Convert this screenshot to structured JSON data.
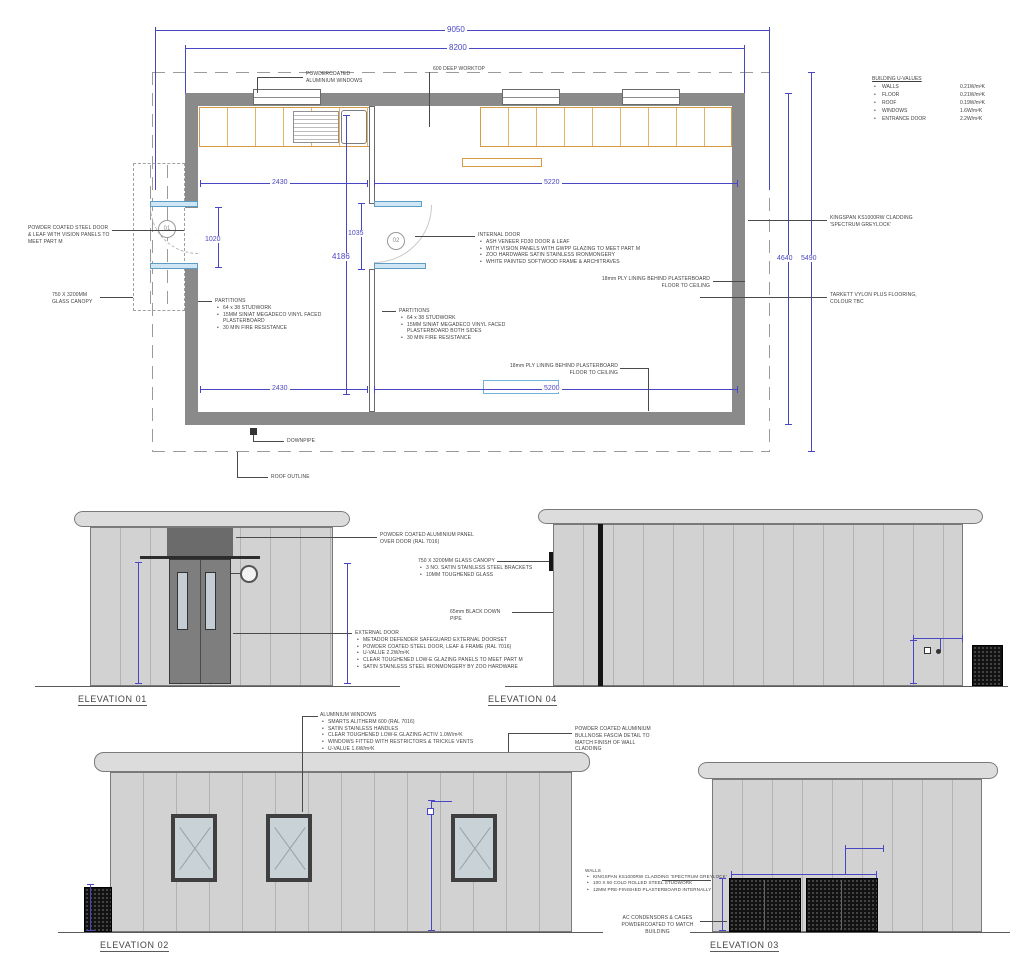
{
  "uvalues": {
    "title": "BUILDING U-VALUES",
    "rows": [
      {
        "name": "WALLS",
        "value": "0.21W/m²K"
      },
      {
        "name": "FLOOR",
        "value": "0.21W/m²K"
      },
      {
        "name": "ROOF",
        "value": "0.19W/m²K"
      },
      {
        "name": "WINDOWS",
        "value": "1.6W/m²K"
      },
      {
        "name": "ENTRANCE DOOR",
        "value": "2.2W/m²K"
      }
    ]
  },
  "plan": {
    "dims": {
      "overall_width": "9050",
      "inner_width": "8200",
      "room1_width_top": "2430",
      "room2_width_top": "5220",
      "door1_opening": "1020",
      "door2_opening": "1035",
      "internal_depth": "4186",
      "room1_width_bottom": "2430",
      "room2_width_bottom": "5200",
      "inner_depth_right": "4640",
      "overall_depth_right": "5490"
    },
    "door1_tag": "01",
    "door2_tag": "02",
    "windows_label": "POWDERCOATED ALUMINIUM WINDOWS",
    "worktop_label": "600 DEEP WORKTOP",
    "entrance_door_label": "POWDER COATED STEEL DOOR & LEAF WITH VISION PANELS TO MEET PART M",
    "canopy_label": "750 X 3200MM GLASS CANOPY",
    "cladding_label": "KINGSPAN KS1000RW CLADDING 'SPECTRUM GREYLOCK'",
    "flooring_label": "TARKETT VYLON PLUS FLOORING, COLOUR TBC",
    "ply_label": "18mm PLY LINING BEHIND PLASTERBOARD FLOOR TO CEILING",
    "downpipe_label": "DOWNPIPE",
    "roof_outline_label": "ROOF OUTLINE",
    "partitions_left": {
      "title": "PARTITIONS",
      "items": [
        "64 x 38 STUDWORK",
        "15MM SINIAT MEGADECO VINYL FACED PLASTERBOARD",
        "30 MIN FIRE RESISTANCE"
      ]
    },
    "internal_door": {
      "title": "INTERNAL DOOR",
      "items": [
        "ASH VENEER FD30 DOOR & LEAF",
        "WITH VISION PANELS WITH GWPP GLAZING TO MEET PART M",
        "ZOO HARDWARE SATIN STAINLESS IRONMONGERY",
        "WHITE PAINTED SOFTWOOD FRAME & ARCHITRAVES"
      ]
    },
    "partitions_right": {
      "title": "PARTITIONS",
      "items": [
        "64 x 38 STUDWORK",
        "15MM SINIAT MEGADECO VINYL FACED PLASTERBOARD BOTH SIDES",
        "30 MIN FIRE RESISTANCE"
      ]
    }
  },
  "elev01": {
    "title": "ELEVATION 01",
    "panel_label": "POWDER COATED ALUMINIUM PANEL OVER DOOR (RAL 7016)",
    "canopy": {
      "title": "750 X 3200MM GLASS CANOPY",
      "items": [
        "3 NO. SATIN STAINLESS STEEL BRACKETS",
        "10MM TOUGHENED GLASS"
      ]
    },
    "downpipe_label": "65mm BLACK DOWN PIPE",
    "external_door": {
      "title": "EXTERNAL DOOR",
      "items": [
        "METADOR DEFENDER SAFEGUARD EXTERNAL DOORSET",
        "POWDER COATED STEEL DOOR, LEAF & FRAME (RAL 7016)",
        "U-VALUE 2.2W/m²K",
        "CLEAR TOUGHENED LOW-E GLAZING PANELS TO MEET PART M",
        "SATIN STAINLESS STEEL IRONMONGERY BY ZOO HARDWARE"
      ]
    }
  },
  "elev04": {
    "title": "ELEVATION 04"
  },
  "elev02": {
    "title": "ELEVATION 02",
    "windows": {
      "title": "ALUMINIUM WINDOWS",
      "items": [
        "SMARTS ALITHERM 600 (RAL 7016)",
        "SATIN STAINLESS HANDLES",
        "CLEAR TOUGHENED LOW-E GLAZING ACTIV 1.0W/m²K",
        "WINDOWS FITTED WITH RESTRICTORS & TRICKLE VENTS",
        "U-VALUE 1.6W/m²K"
      ]
    },
    "fascia_label": "POWDER COATED ALUMINIUM BULLNOSE FASCIA DETAIL TO MATCH FINISH OF WALL CLADDING"
  },
  "elev03": {
    "title": "ELEVATION 03",
    "walls": {
      "title": "WALLS",
      "items": [
        "KINGSPAN KS1000RW CLADDING 'SPECTRUM GREYLOCK'",
        "100 X 50 COLD ROLLED STEEL STUDWORK",
        "12MM PRE-FINISHED PLASTERBOARD INTERNALLY"
      ]
    },
    "ac_label": "AC CONDENSORS & CAGES POWDERCOATED TO MATCH BUILDING"
  },
  "colors": {
    "dimension_blue": "#4946c4",
    "wall_grey": "#8a8a8a",
    "counter_orange": "#d79a45",
    "door_leaf_blue": "#cfe7f5"
  }
}
